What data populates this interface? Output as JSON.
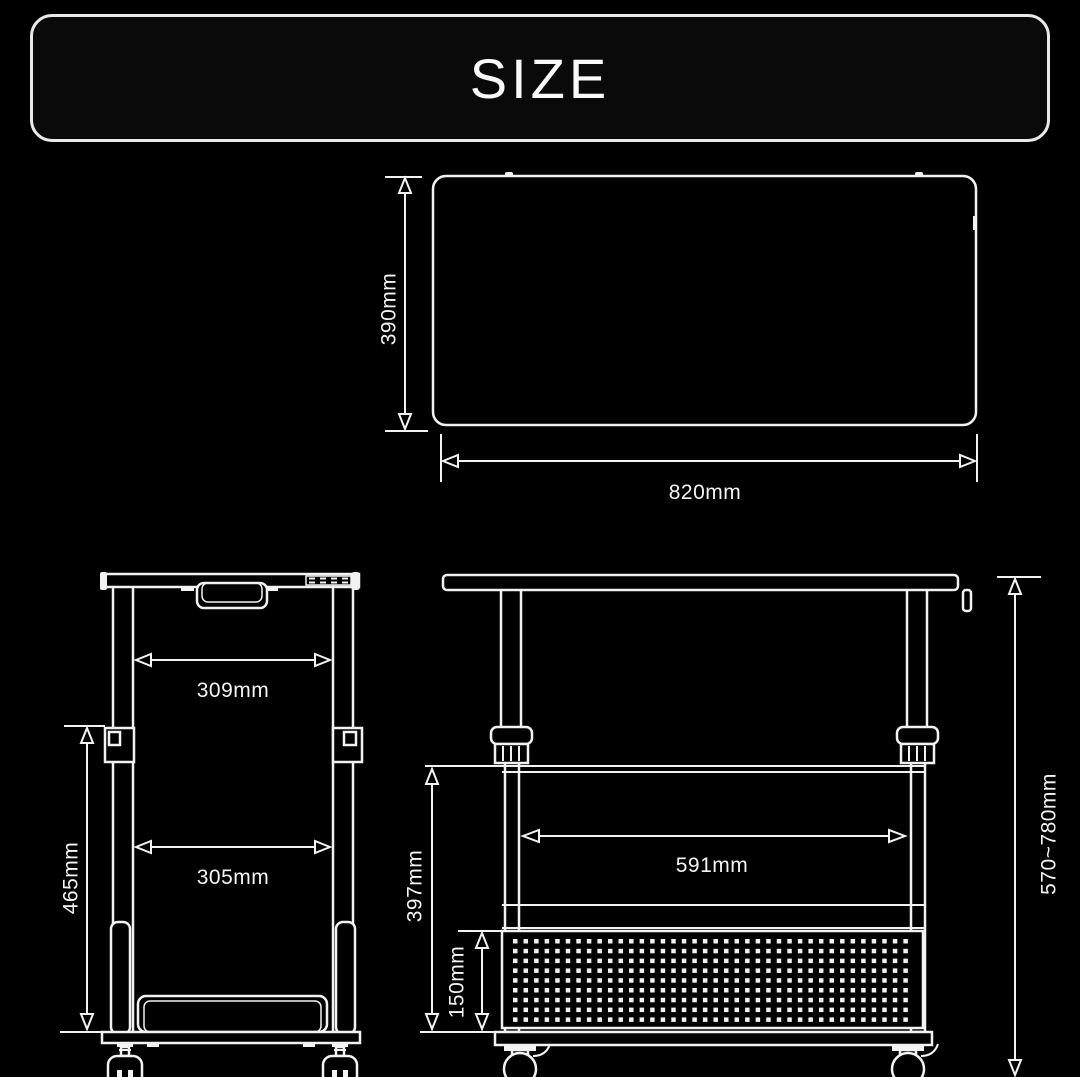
{
  "banner": {
    "title": "SIZE"
  },
  "colors": {
    "background": "#000000",
    "line": "#f2f2f2",
    "text": "#f5f5f5"
  },
  "top_view": {
    "description": "tabletop-top-view",
    "height_label": "390mm",
    "width_label": "820mm"
  },
  "front_view": {
    "description": "front-view",
    "upper_inner_width_label": "309mm",
    "lower_inner_width_label": "305mm",
    "leg_height_label": "465mm"
  },
  "side_view": {
    "description": "side-view",
    "shelf_width_label": "591mm",
    "lower_section_height_label": "397mm",
    "basket_height_label": "150mm",
    "overall_height_label": "570~780mm",
    "panel_grid": {
      "rows": 9,
      "cols": 38,
      "x0": 513,
      "y0": 939,
      "dx": 10.55,
      "dy": 9.8,
      "size": 4.5
    }
  }
}
